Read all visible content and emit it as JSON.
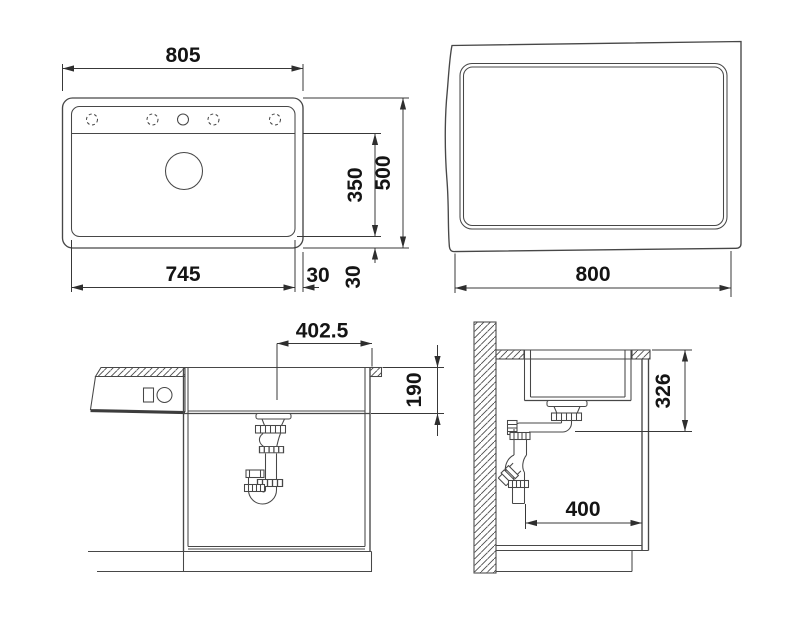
{
  "drawing": {
    "type": "sink-installation-technical-drawing",
    "background": "#ffffff",
    "line_color": "#474747",
    "text_color": "#141414",
    "views": {
      "plan": {
        "name": "sink-plan-view",
        "dims": {
          "overall_width": "805",
          "bowl_width": "745",
          "bowl_depth": "350",
          "overall_depth": "500",
          "rim_right": "30",
          "rim_bottom": "30"
        }
      },
      "cutout": {
        "name": "worktop-cutout-view",
        "dims": {
          "cutout_width": "800"
        }
      },
      "front_section": {
        "name": "front-section-view",
        "dims": {
          "drain_center_offset": "402.5",
          "bowl_height": "190"
        }
      },
      "side_section": {
        "name": "side-section-view",
        "dims": {
          "outlet_height": "326",
          "wall_to_front": "400"
        }
      }
    }
  }
}
